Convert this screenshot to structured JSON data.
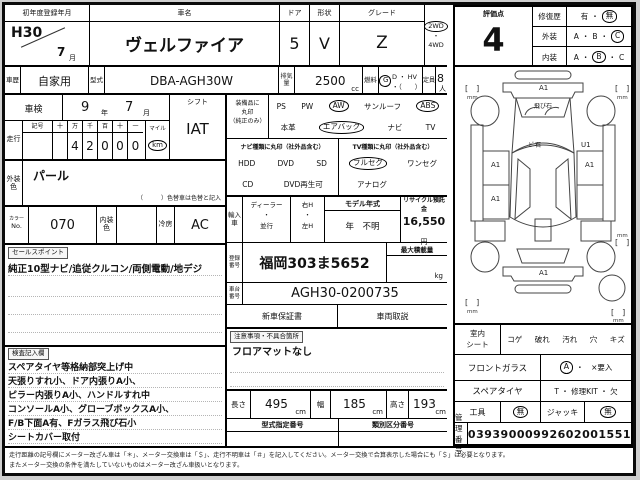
{
  "header": {
    "first_reg_label": "初年度登録年月",
    "first_reg_year": "H30",
    "first_reg_month": "7",
    "month_unit": "月",
    "car_name_label": "車名",
    "car_name": "ヴェルファイア",
    "door_label": "ドア",
    "door_count": "5",
    "shape_label": "形状",
    "shape": "V",
    "grade_label": "グレード",
    "grade": "Z",
    "drive_2wd": "2WD",
    "dot": "・",
    "drive_4wd": "4WD",
    "history_label": "車歴",
    "history": "自家用",
    "model_code_label": "型式",
    "model_code": "DBA-AGH30W",
    "displacement_label": "排気量",
    "displacement": "2500",
    "displacement_unit": "cc",
    "fuel_label": "燃料",
    "fuel_selected": "G",
    "fuel_rest": "D ・ HV ・（　　）",
    "capacity_label": "定員",
    "capacity": "8",
    "capacity_unit": "人"
  },
  "left": {
    "shaken_label": "車検",
    "shaken_year": "9",
    "year_unit": "年",
    "shaken_month": "7",
    "month_unit": "月",
    "shift_label": "シフト",
    "shift_value": "IAT",
    "mileage_label": "走行",
    "odometer_headers": [
      "記号",
      "十",
      "万",
      "千",
      "百",
      "十",
      "一"
    ],
    "odometer_digits": [
      "",
      "",
      "4",
      "2",
      "0",
      "0",
      "0"
    ],
    "mile_label": "マイル",
    "km_label": "km",
    "ext_color_label": "外装色",
    "ext_color": "パール",
    "color_change_note": "（　　　）色替車は色替と記入",
    "color_no_label1": "カラー",
    "color_no_label2": "No.",
    "color_no": "070",
    "int_color_label": "内装色",
    "int_color": "",
    "cooling_label": "冷房",
    "cooling": "AC",
    "sales_point_label": "セールスポイント",
    "sales_point": "純正10型ナビ/追従クルコン/両側電動/地デジ",
    "inspector_label": "検査記入欄",
    "inspector_notes": [
      "スペアタイヤ等格納部突上げ中",
      "天張りすれ小、ドア内張りA小、",
      "ピラー内張りA小、ハンドルすれ中",
      "コンソールA小、グローブボックスA小、",
      "F/B下面A有、Fガラス飛び石小",
      "シートカバー取付"
    ]
  },
  "equipment": {
    "label_line1": "装備品に",
    "label_line2": "丸印",
    "label_line3": "（純正のみ）",
    "row1": [
      "PS",
      "PW",
      "AW",
      "サンルーフ",
      "ABS"
    ],
    "row2": [
      "本革",
      "エアバック",
      "ナビ",
      "TV"
    ],
    "nav_type_label": "ナビ種類に丸印（社外品含む）",
    "tv_type_label": "TV種類に丸印（社外品含む）",
    "nav_row1": [
      "HDD",
      "DVD",
      "SD"
    ],
    "nav_row2": [
      "CD",
      "DVD再生可"
    ],
    "tv_row1": [
      "フルセグ",
      "ワンセグ"
    ],
    "tv_row2": [
      "アナログ"
    ]
  },
  "middle": {
    "import_label": "輸入車",
    "dealer": "ディーラー",
    "dot": "・",
    "parallel": "並行",
    "right_h": "右H",
    "left_h": "左H",
    "model_year_label": "モデル年式",
    "model_year_value": "年　不明",
    "recycle_label": "リサイクル預託金",
    "recycle_value": "16,550",
    "yen_unit": "円",
    "reg_no_label": "登録番号",
    "reg_no": "福岡303ま5652",
    "max_load_label": "最大積載量",
    "max_load_unit": "kg",
    "chassis_label": "車台番号",
    "chassis_no": "AGH30-0200735",
    "warranty_label": "新車保証書",
    "manual_label": "車両取説",
    "caution_label": "注意事項・不具合箇所",
    "caution_text": "フロアマットなし",
    "length_label": "長さ",
    "length": "495",
    "width_label": "幅",
    "width": "185",
    "height_label": "高さ",
    "height": "193",
    "cm_unit": "cm",
    "type_desig_label": "型式指定番号",
    "class_no_label": "類別区分番号"
  },
  "evaluation": {
    "score_label": "評価点",
    "score": "4",
    "repair_label": "修復歴",
    "repair_yes": "有",
    "repair_no": "無",
    "exterior_label": "外装",
    "interior_label": "内装",
    "grade_a": "A",
    "grade_b": "B",
    "grade_c": "C",
    "dot": "・"
  },
  "diagram": {
    "front_bumper": "A1",
    "windshield_note": "飛び石",
    "roof_note": "ﾋﾞ石",
    "right_front": "U1",
    "left_front_door": "A1",
    "right_front_door": "A1",
    "left_rear_door": "A1",
    "rear": "A1",
    "bracket": "[　]",
    "mm": "mm"
  },
  "right_table": {
    "seat_label1": "室内",
    "seat_label2": "シート",
    "seat_options": [
      "コゲ",
      "破れ",
      "汚れ",
      "穴",
      "キズ"
    ],
    "glass_label": "フロントガラス",
    "glass_value": "A",
    "glass_rest": "・　×要入",
    "spare_label": "スペアタイヤ",
    "spare_options": "T ・ 修理KIT ・ 欠",
    "tool_label": "工具",
    "tool_value": "無",
    "jack_label": "ジャッキ",
    "jack_value": "無",
    "mgmt_label": "管理番号",
    "mgmt_no": "03939000992602001551"
  },
  "footer": {
    "note1": "走行距離の記号欄にメーター改ざん車は「＊」、メーター交換車は「＄」、走行不明車は「＃」を記入してください。メーター交換で合算表示した場合にも「＄」は必要となります。",
    "note2": "またメーター交換の条件を満たしていないものはメーター改ざん車扱いとなります。"
  }
}
